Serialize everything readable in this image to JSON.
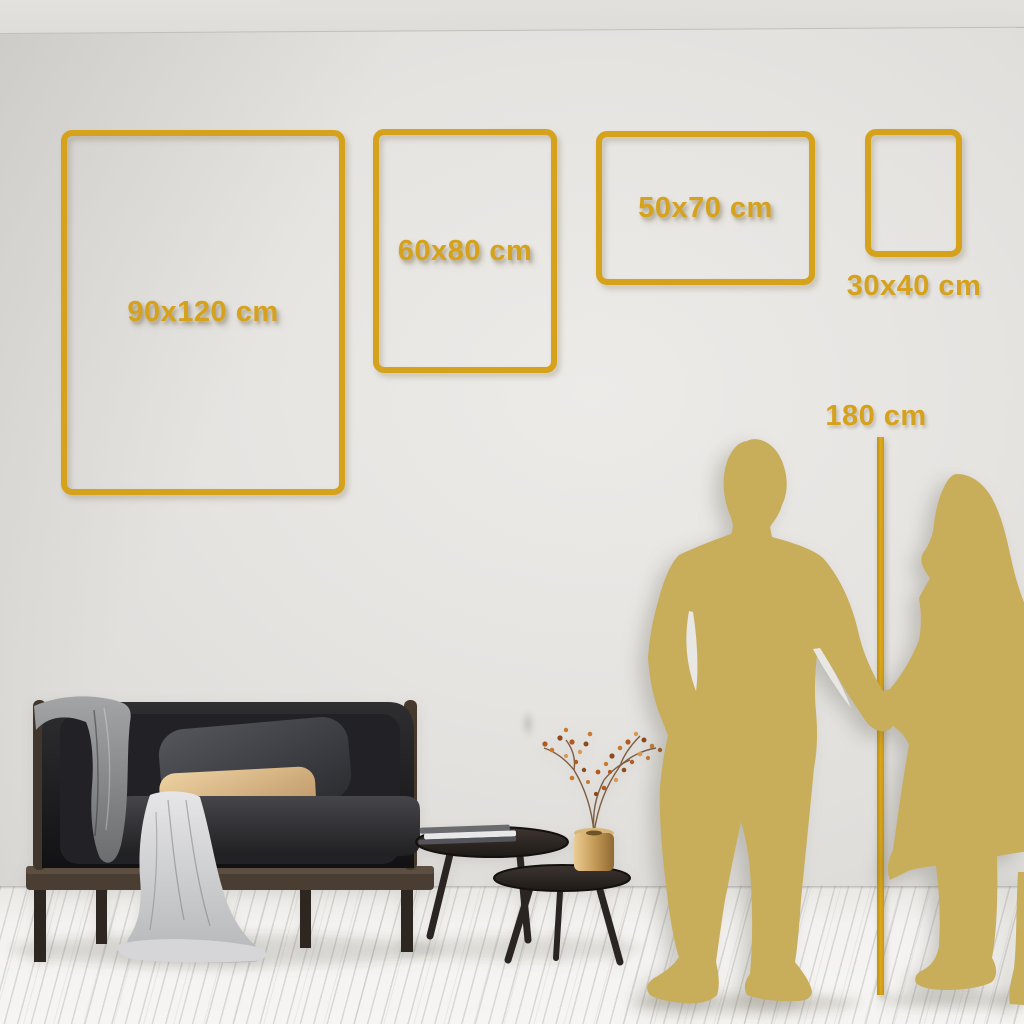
{
  "colors": {
    "accent_gold": "#D6A21C",
    "silhouette_gold": "#C8AD5B",
    "wall": "#E4E2DF",
    "floor": "#F3F2F0"
  },
  "size_guide": {
    "frames": [
      {
        "label": "90x120 cm"
      },
      {
        "label": "60x80 cm"
      },
      {
        "label": "50x70 cm"
      },
      {
        "label": "30x40 cm"
      }
    ],
    "height_marker": {
      "label": "180 cm"
    }
  }
}
